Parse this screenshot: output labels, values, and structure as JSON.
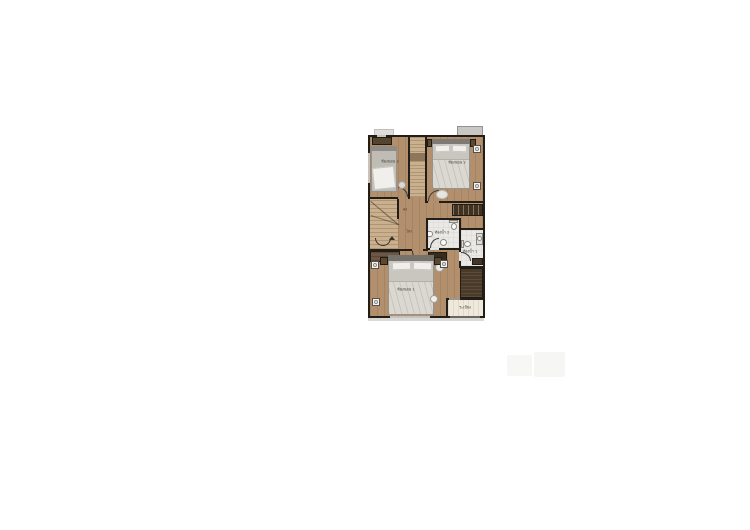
{
  "page": {
    "background": "#ffffff"
  },
  "plan": {
    "type": "floor-plan",
    "rooms": {
      "bedroom1": {
        "label": "ห้องนอน 1"
      },
      "bedroom2": {
        "label": "ห้องนอน 2"
      },
      "bedroom3": {
        "label": "ห้องนอน 3"
      },
      "bath1": {
        "label": "ห้องน้ำ 1"
      },
      "bath2": {
        "label": "ห้องน้ำ 2"
      },
      "hall": {
        "label": "โถง"
      },
      "stairs": {
        "label": "ลง"
      },
      "balcony": {
        "label": "ระเบียง"
      }
    },
    "colors": {
      "wall": "#211e1a",
      "wood_floor": "#b3906d",
      "tile_floor": "#eae9e5",
      "balcony_floor": "#efe9db",
      "stair_tread": "#cbb08e",
      "dark_wood_furniture": "#3f3222",
      "wardrobe": "#4a3a28",
      "bed": "#c9c6c0",
      "pillow": "#f0efeb",
      "label_text": "#3e3a34",
      "ac_ledge": "#c9c7c3",
      "watermark": "#f6f6f4"
    }
  }
}
